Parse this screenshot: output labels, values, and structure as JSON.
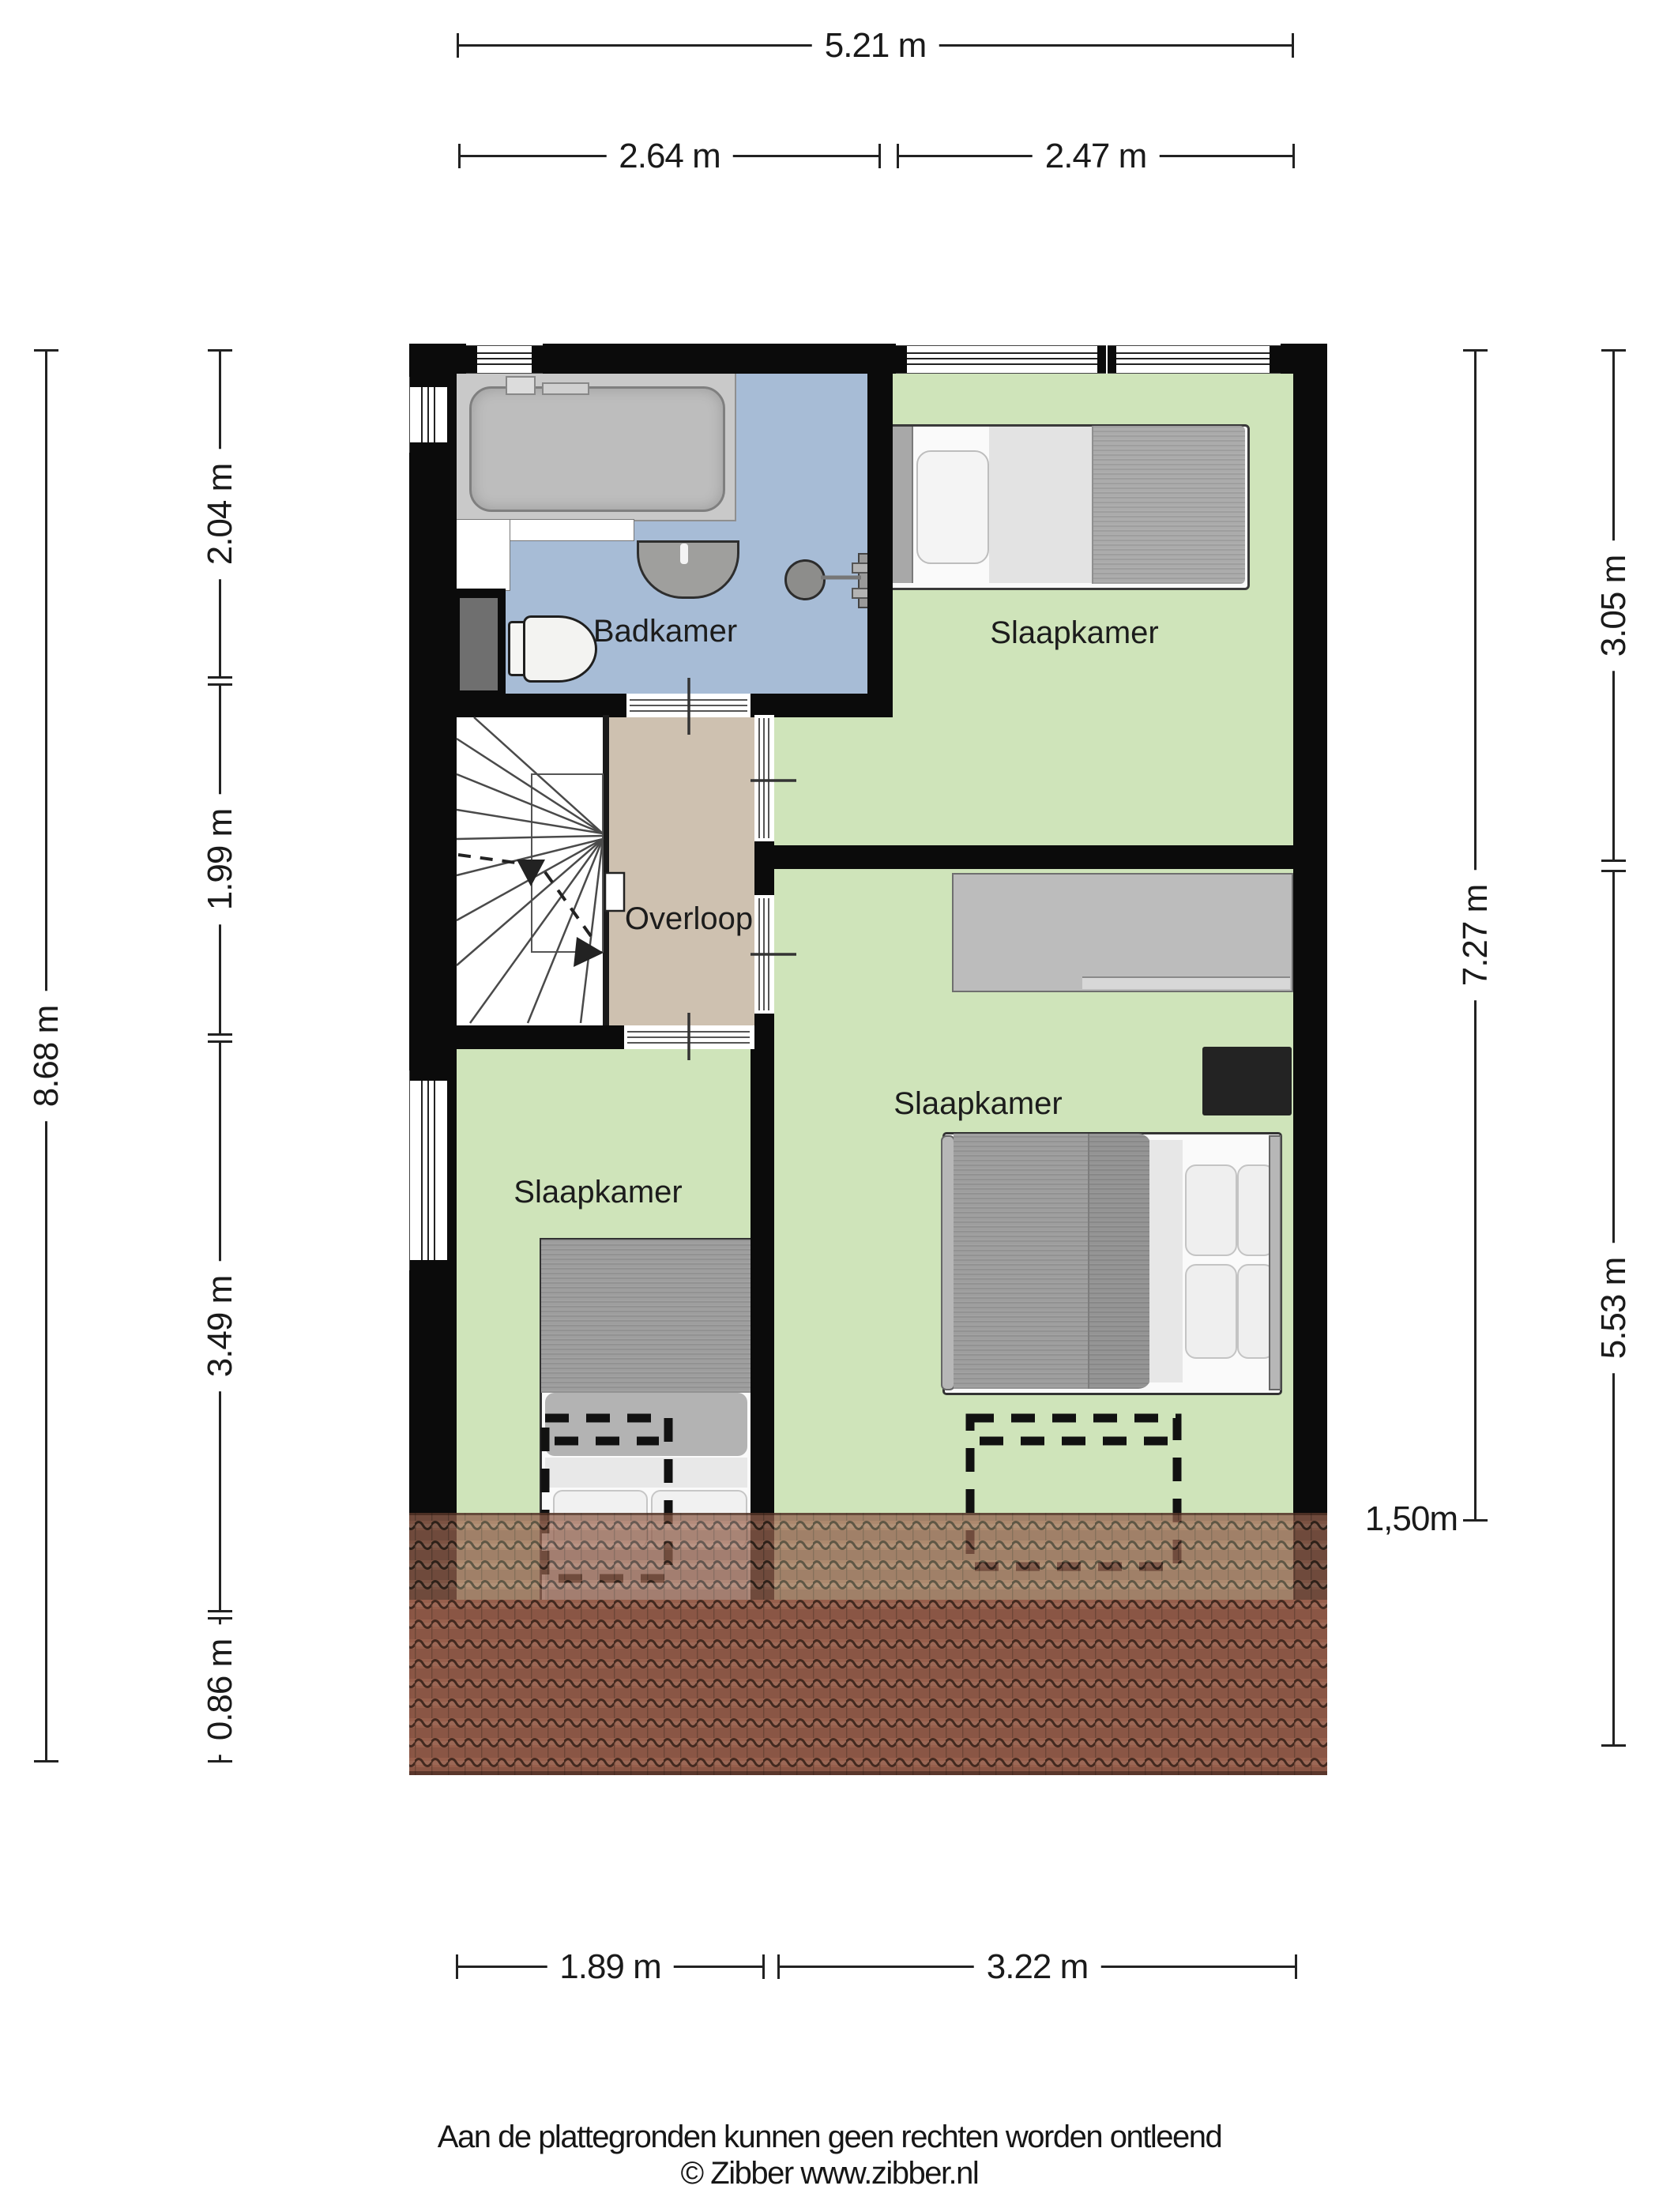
{
  "footer": {
    "line1": "Aan de plattegronden kunnen geen rechten worden ontleend",
    "line2": "© Zibber www.zibber.nl"
  },
  "rooms": {
    "bathroom": "Badkamer",
    "bedroom_top": "Slaapkamer",
    "landing": "Overloop",
    "bedroom_left": "Slaapkamer",
    "bedroom_right": "Slaapkamer"
  },
  "dimensions": {
    "top": {
      "total": "5.21 m",
      "left": "2.64 m",
      "right": "2.47 m"
    },
    "left": {
      "total": "8.68 m",
      "seg1": "2.04 m",
      "seg2": "1.99 m",
      "seg3": "3.49 m",
      "seg4": "0.86 m"
    },
    "right": {
      "inner": "7.27 m",
      "seg1": "3.05 m",
      "seg2": "5.53 m",
      "roof_height": "1,50m"
    },
    "bottom": {
      "left": "1.89 m",
      "right": "3.22 m"
    }
  },
  "colors": {
    "wall": "#0b0b0b",
    "floor_bathroom": "#a7bcd6",
    "floor_bedroom": "#cfe4ba",
    "floor_landing": "#cec1b0",
    "stairwell": "#ffffff",
    "roof_tile": "#a06a55",
    "dimension_line": "#222222"
  }
}
